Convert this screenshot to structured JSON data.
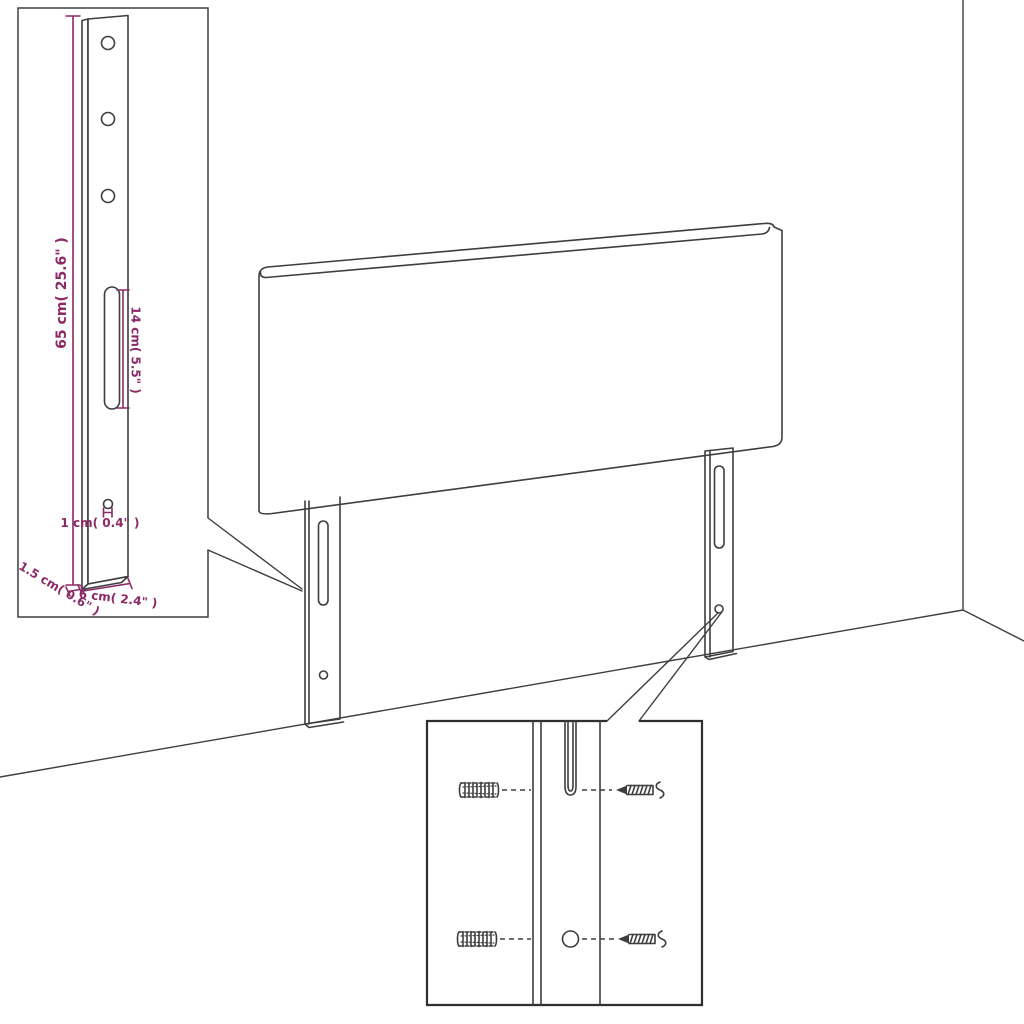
{
  "diagram": {
    "type": "furniture-assembly-diagram",
    "subject": "Upholstered headboard with two mounting legs shown against a wall corner, with a leg side-view dimension inset and a wall-mounting hardware inset",
    "colors": {
      "line": "#3e3e3e",
      "dimension": "#8b2a66",
      "background": "#ffffff",
      "inset_border": "#2f2f2f"
    },
    "left_inset": {
      "name": "leg side-view detail with dimensions",
      "dim_height": "65 cm( 25.6\" )",
      "dim_slot": "14 cm( 5.5\" )",
      "dim_hole": "1 cm( 0.4\" )",
      "dim_thickness": "1.5 cm( 0.6\" )",
      "dim_width": "6 cm( 2.4\" )"
    },
    "bottom_inset": {
      "name": "wall-mounting detail",
      "parts": [
        "wall plug",
        "screw",
        "wall plug",
        "screw"
      ]
    }
  }
}
